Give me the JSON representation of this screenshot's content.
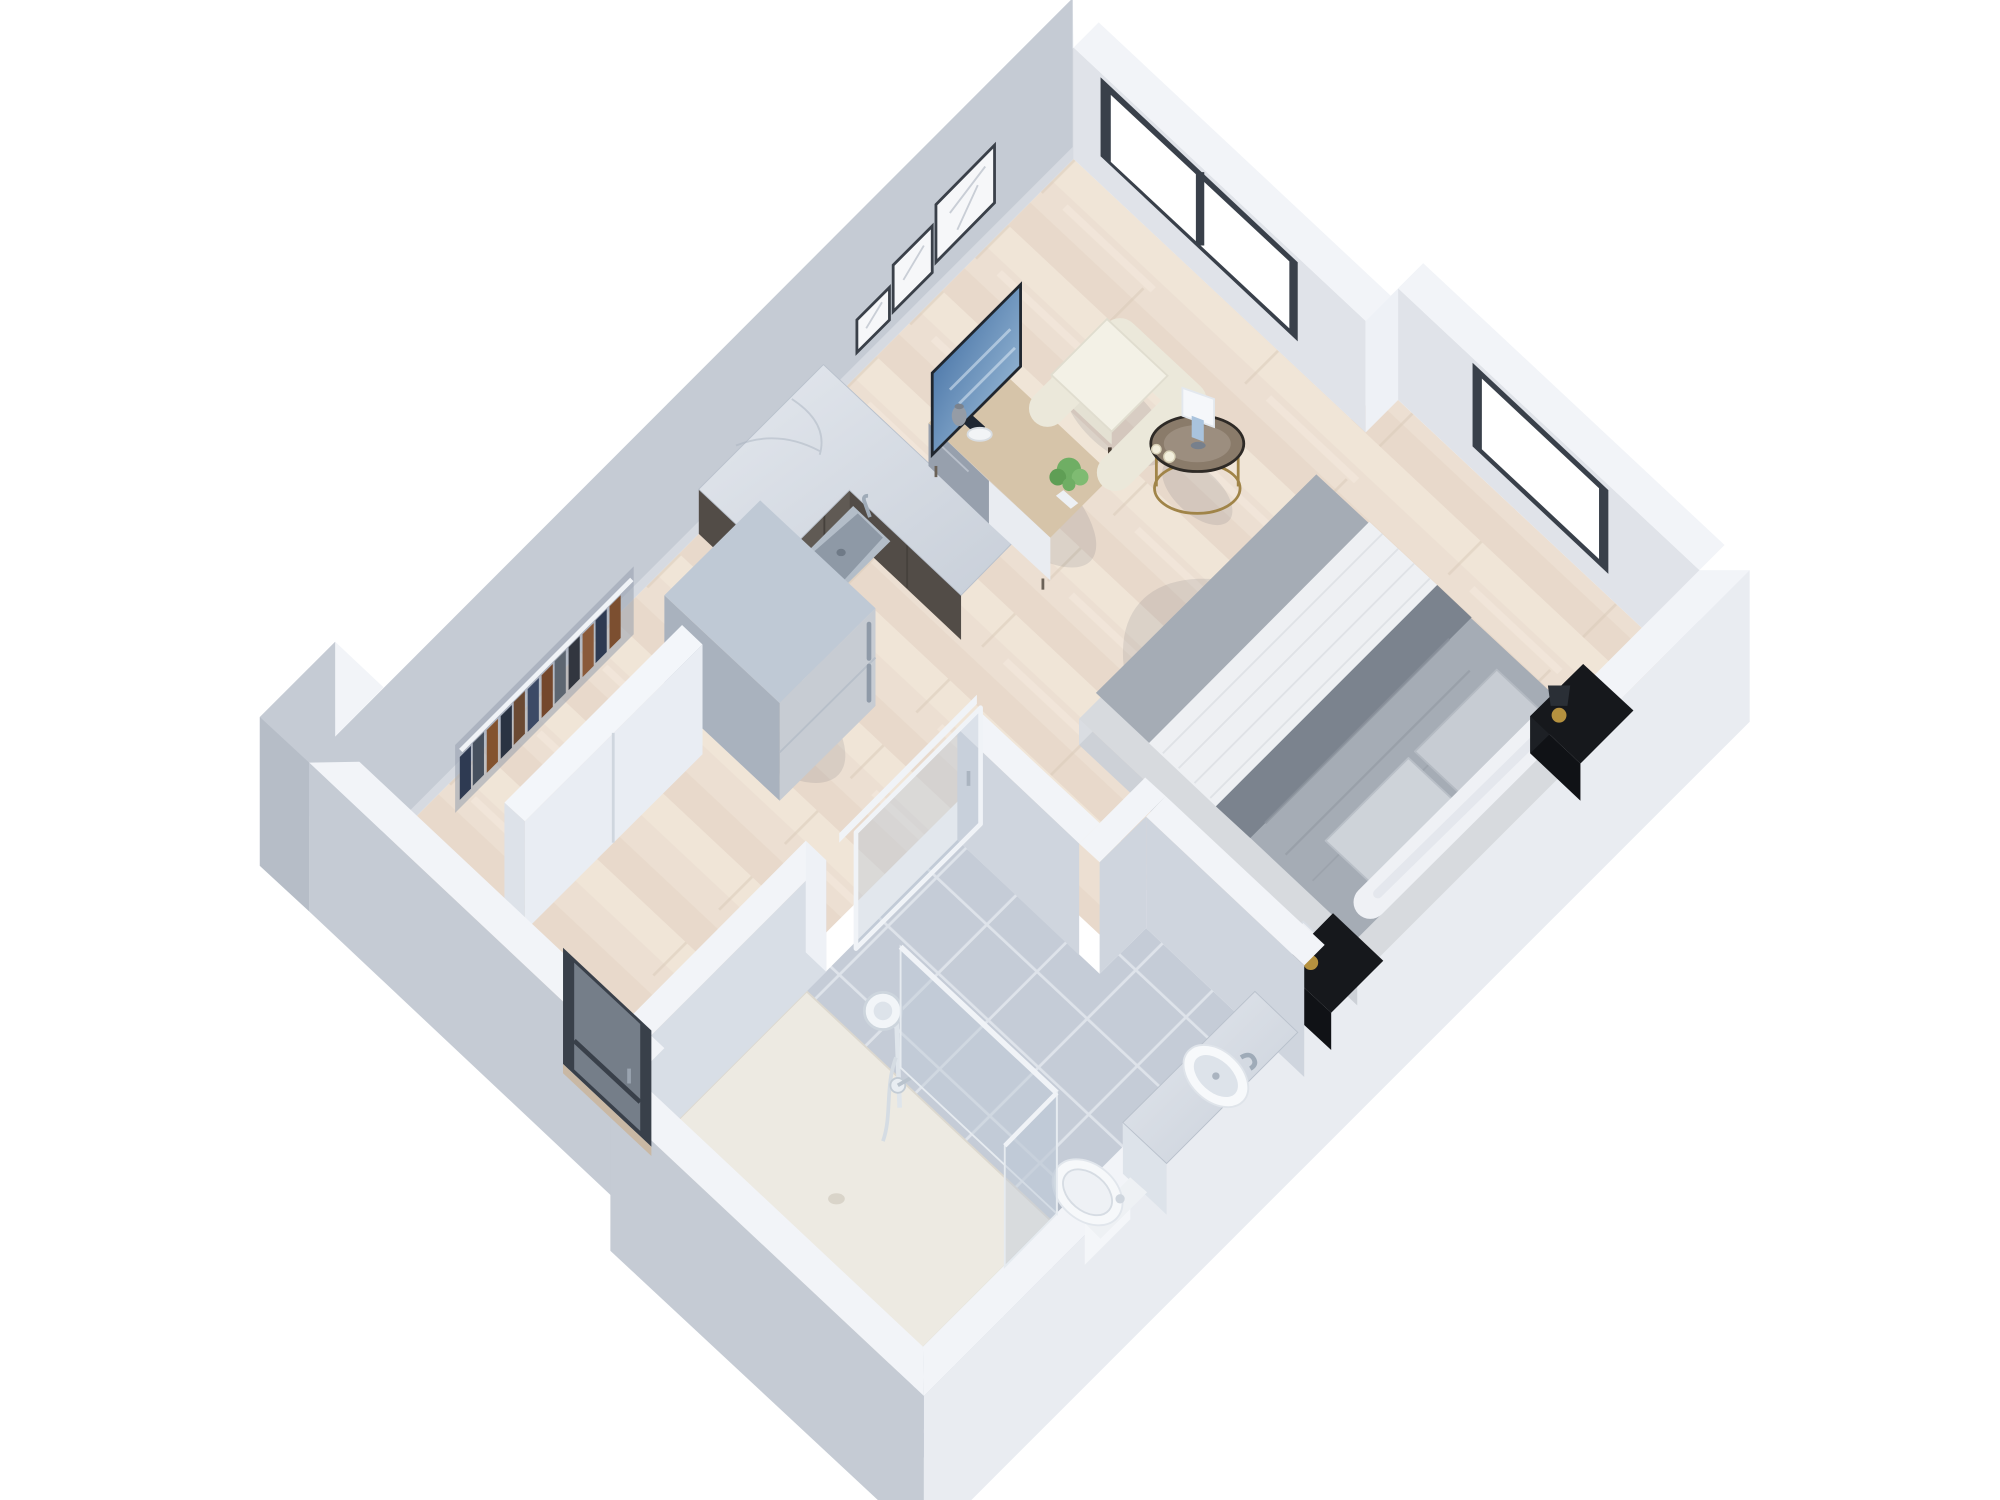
{
  "scene": {
    "type": "3d-floorplan-render",
    "view": "isometric dollhouse cutaway, rotated ~43 degrees",
    "rooms": [
      {
        "name": "living-sleeping-area",
        "floor": "light oak plank"
      },
      {
        "name": "kitchenette",
        "floor": "light oak plank"
      },
      {
        "name": "entry-corridor",
        "floor": "light oak plank"
      },
      {
        "name": "bathroom",
        "floor": "grey ceramic tile"
      }
    ],
    "furniture": [
      "wall-art-frames",
      "double-window",
      "square-window",
      "armchair",
      "round-side-table",
      "table-lamp",
      "candles",
      "tv",
      "tv-console",
      "potted-plant",
      "vase",
      "bowl",
      "kitchen-counter",
      "kitchen-sink",
      "refrigerator",
      "wardrobe-sliding-doors",
      "hanging-clothes",
      "double-bed",
      "pillows",
      "white-bolster",
      "nightstand-head",
      "nightstand-foot",
      "gold-lamp",
      "entry-glass-door",
      "bathroom-sliding-glass-door",
      "vanity-round-basin",
      "faucet",
      "toilet",
      "walk-in-shower",
      "shower-glass-panels",
      "shower-fixture"
    ]
  },
  "colors": {
    "bg": "#ffffff",
    "wall_top": "#f2f4f8",
    "wall_inner_nw": "#d6dae1",
    "wall_inner_ne": "#e0e3e9",
    "wall_bath_face": "#cfd5de",
    "wall_bath_light": "#d8dee6",
    "wall_outer": "#c5cbd4",
    "wall_outer_dark": "#b6bdc7",
    "wall_outer_light": "#e9ecf1",
    "wall_cap": "#eef1f6",
    "floor_wood": "#ecdfd2",
    "wood_light": "#f3e9db",
    "wood_dark": "#e3d4c3",
    "wood_seam": "#d8c9b8",
    "tile": "#c5ccd7",
    "tile_grout": "#dee3ea",
    "shower_tray": "#edeae2",
    "marble_light": "#e4e8ee",
    "marble_dark": "#c8cfd9",
    "cabinet": "#605a54",
    "cabinet_dark": "#524c47",
    "steel": "#c7ccd3",
    "steel_top": "#bfc9d5",
    "steel_side": "#a9b2be",
    "steel_handle": "#8f9aa8",
    "console_wood": "#d6c4a9",
    "console_weave": "#97a0ad",
    "console_door": "#e9ecf1",
    "closet_door": "#e9edf3",
    "closet_top": "#f3f6fa",
    "rail_white": "#f0f3f7",
    "bed_base": "#d7dade",
    "duvet": "#a5acb5",
    "duvet_dark": "#7b838e",
    "throw_white": "#eef0f3",
    "pillow": "#c7ccd3",
    "bolster": "#eff1f5",
    "nightstand": "#16181c",
    "gold": "#b5913f",
    "chair": "#ebe8da",
    "chair_cushion": "#f3f1e6",
    "chair_leg": "#4a3f35",
    "table_wood": "#8a7b6a",
    "table_gold": "#a08448",
    "lamp_white": "#f5f7fa",
    "lamp_blue": "#a9c3dd",
    "plant": "#6fae64",
    "plant_dark": "#5f9e55",
    "tv_blue": "#35639b",
    "tv_blue_light": "#aac8e0",
    "tv_dark": "#1f2733",
    "frame_dark": "#39404a",
    "glass": "rgba(190,201,214,0.45)",
    "white_fixture": "#f4f6f9",
    "fixture_shade": "#dde3ea",
    "chrome": "#9fabb8",
    "shadow": "rgba(40,50,70,0.10)",
    "art_frame": "#3a4049",
    "art_paper": "#f6f7f9"
  }
}
